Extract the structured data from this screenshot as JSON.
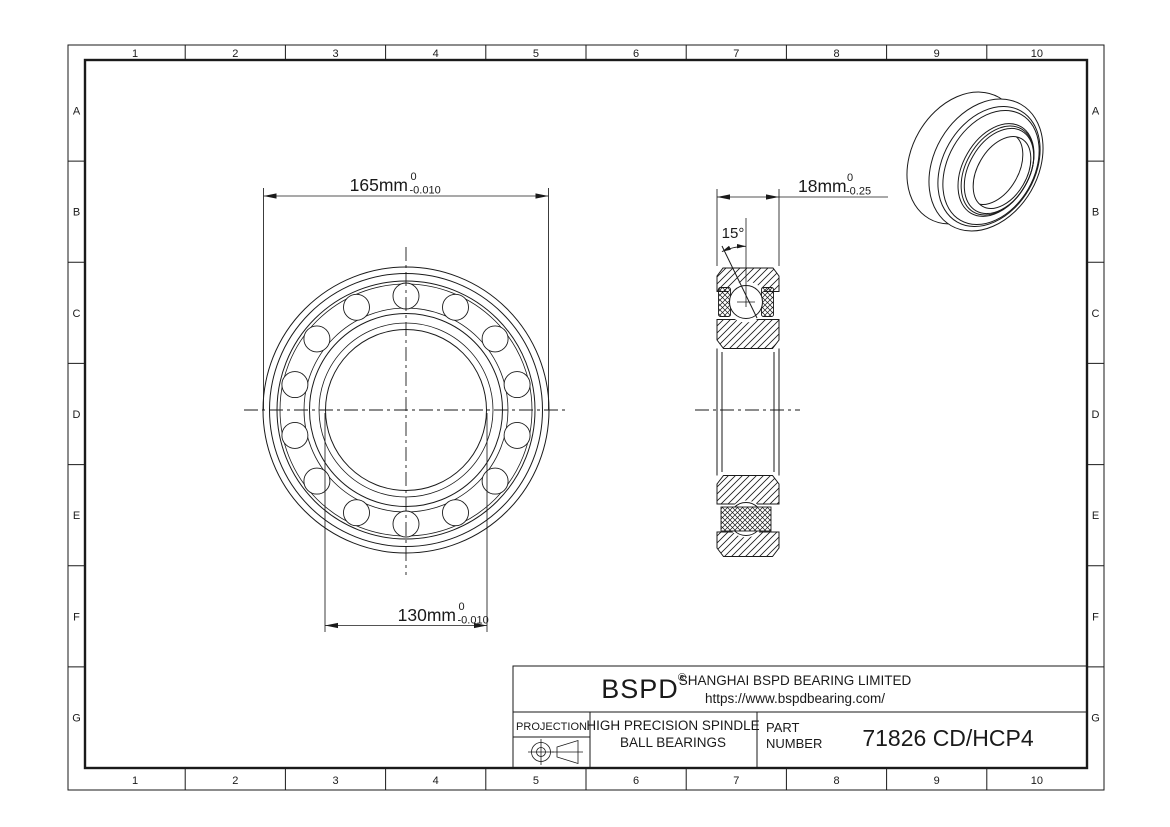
{
  "page": {
    "background": "#ffffff",
    "line_color": "#1a1a1a"
  },
  "border": {
    "cols": [
      "1",
      "2",
      "3",
      "4",
      "5",
      "6",
      "7",
      "8",
      "9",
      "10"
    ],
    "rows": [
      "A",
      "B",
      "C",
      "D",
      "E",
      "F",
      "G"
    ]
  },
  "dims": {
    "od": {
      "value": "165mm",
      "tol_top": "0",
      "tol_bottom": "-0.010"
    },
    "bore": {
      "value": "130mm",
      "tol_top": "0",
      "tol_bottom": "-0.010"
    },
    "width": {
      "value": "18mm",
      "tol_top": "0",
      "tol_bottom": "-0.25"
    },
    "contact_angle": "15°"
  },
  "title_block": {
    "logo": "BSPD",
    "registered_mark": "®",
    "company": "SHANGHAI BSPD BEARING LIMITED",
    "website": "https://www.bspdbearing.com/",
    "projection_label": "PROJECTION",
    "product_line1": "HIGH  PRECISION SPINDLE",
    "product_line2": "BALL BEARINGS",
    "part_label1": "PART",
    "part_label2": "NUMBER",
    "part_number": "71826 CD/HCP4"
  }
}
